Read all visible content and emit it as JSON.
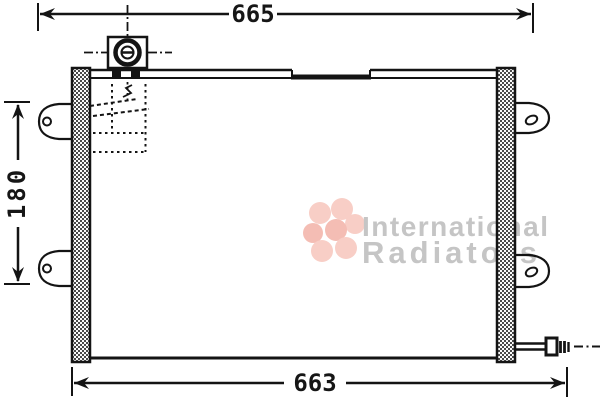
{
  "dimensions": {
    "top": "665",
    "left": "180",
    "bottom": "663"
  },
  "watermark": {
    "line1": "International",
    "line2": "Radiators",
    "text_color": "#c5c5c5",
    "logo_color": "#f6beb4",
    "logo_color_dark": "#f1a89c"
  },
  "colors": {
    "ink": "#141414",
    "background": "#ffffff",
    "tank_hatch": "#4a4a4a"
  }
}
